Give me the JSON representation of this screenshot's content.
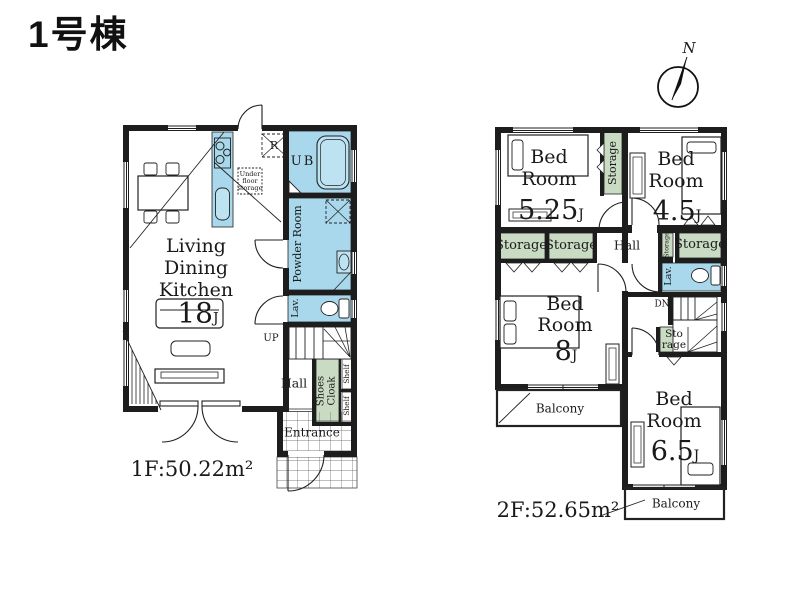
{
  "title": "1号棟",
  "compass": {
    "north": "N"
  },
  "colors": {
    "wall": "#1d1d1d",
    "water_blue": "#a9d8ec",
    "storage_green": "#c9dbc3",
    "paper": "#ffffff"
  },
  "floor1": {
    "area": "1F:50.22m²",
    "ldk": {
      "line1": "Living",
      "line2": "Dining",
      "line3": "Kitchen",
      "size": "18",
      "unit": "J"
    },
    "ub": "UB",
    "refrigerator": "R",
    "under_floor_storage": {
      "line1": "Under",
      "line2": "floor",
      "line3": "storage"
    },
    "powder_room": "Powder Room",
    "lav": "Lav.",
    "up": "UP",
    "hall": "Hall",
    "shoes_cloak": {
      "line1": "Shoes",
      "line2": "Cloak"
    },
    "shelf_upper": "Shelf",
    "shelf_lower": "Shelf",
    "entrance": "Entrance"
  },
  "floor2": {
    "area": "2F:52.65m²",
    "bedroom_525": {
      "line1": "Bed",
      "line2": "Room",
      "size": "5.25",
      "unit": "J"
    },
    "bedroom_45": {
      "line1": "Bed",
      "line2": "Room",
      "size": "4.5",
      "unit": "J"
    },
    "bedroom_8": {
      "line1": "Bed",
      "line2": "Room",
      "size": "8",
      "unit": "J"
    },
    "bedroom_65": {
      "line1": "Bed",
      "line2": "Room",
      "size": "6.5",
      "unit": "J"
    },
    "storage_tall": "Storage",
    "storage_left_a": "Storage",
    "storage_left_b": "Storage",
    "storage_right": "Storage",
    "storage_narrow": "Storage",
    "storage_stair": {
      "line1": "Sto",
      "line2": "rage"
    },
    "hall": "Hall",
    "lav": "Lav.",
    "dn": "DN",
    "balcony_left": "Balcony",
    "balcony_right": "Balcony"
  }
}
